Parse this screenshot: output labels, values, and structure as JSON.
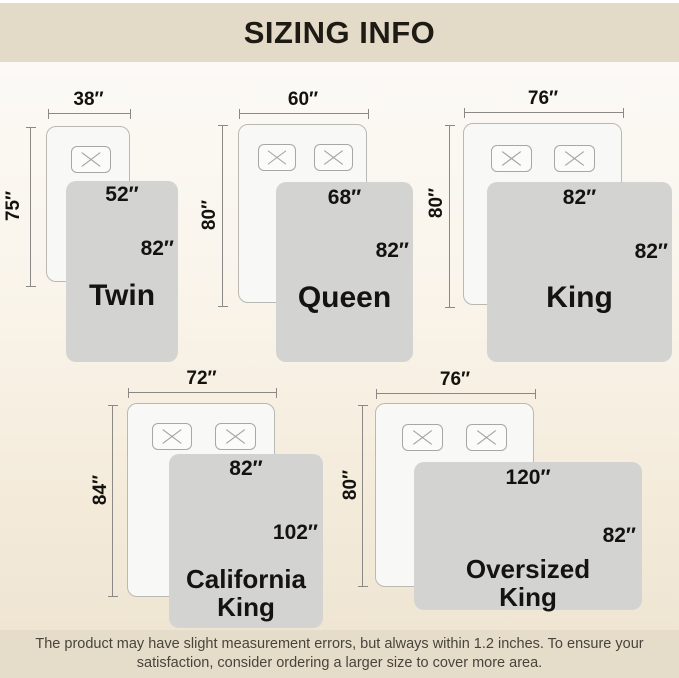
{
  "header": {
    "title": "SIZING INFO"
  },
  "sizes": [
    {
      "name": "Twin",
      "bed_width": "38″",
      "bed_length": "75″",
      "blanket_width": "52″",
      "blanket_length": "82″"
    },
    {
      "name": "Queen",
      "bed_width": "60″",
      "bed_length": "80″",
      "blanket_width": "68″",
      "blanket_length": "82″"
    },
    {
      "name": "King",
      "bed_width": "76″",
      "bed_length": "80″",
      "blanket_width": "82″",
      "blanket_length": "82″"
    },
    {
      "name": "California King",
      "bed_width": "72″",
      "bed_length": "84″",
      "blanket_width": "82″",
      "blanket_length": "102″"
    },
    {
      "name": "Oversized King",
      "bed_width": "76″",
      "bed_length": "80″",
      "blanket_width": "120″",
      "blanket_length": "82″"
    }
  ],
  "footer": {
    "lines": [
      "The product may have slight measurement errors, but always within 1.2 inches. To ensure your",
      "satisfaction, consider ordering a larger size to cover more area."
    ]
  },
  "colors": {
    "band": "#e4dac8",
    "blanket_gray": "#d3d3d2",
    "bed_white": "#f8f8f7",
    "label_text": "#14120f"
  }
}
